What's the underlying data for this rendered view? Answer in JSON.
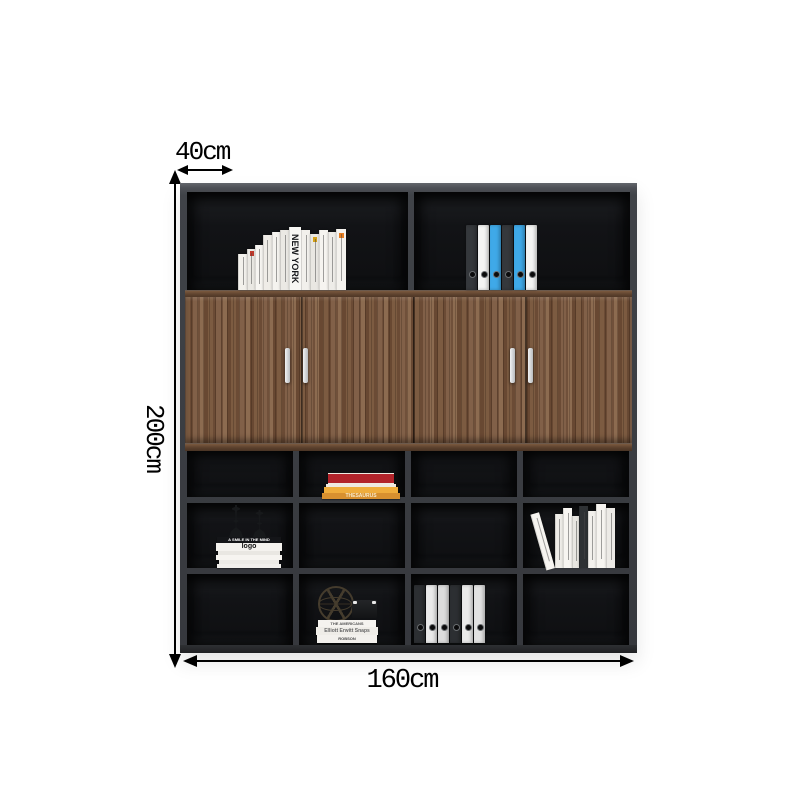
{
  "image": {
    "description": "Walnut and dark-grey office bookcase cabinet shown with measurement arrows",
    "background": "#ffffff"
  },
  "dimensions": {
    "depth": "40cm",
    "height": "200cm",
    "width": "160cm"
  },
  "colors": {
    "line": "#000000",
    "frame": "#3f4247",
    "interior": "#101114",
    "wood": "#7b5a41",
    "wood_trim": "#5e432f",
    "handle": "#e8e9ea",
    "binder_blue": "#3fa9e8"
  },
  "top_shelf": {
    "left_books": [
      {
        "w": 9,
        "h": 36,
        "c": "#f3f1ec"
      },
      {
        "w": 8,
        "h": 41,
        "c": "#eae8e3",
        "mark": "#c0392b"
      },
      {
        "w": 7,
        "h": 45,
        "c": "#f7f5f1"
      },
      {
        "w": 9,
        "h": 55,
        "c": "#efece7"
      },
      {
        "w": 8,
        "h": 58,
        "c": "#f5f3ef"
      },
      {
        "w": 9,
        "h": 60,
        "c": "#ebe9e4"
      },
      {
        "w": 12,
        "h": 63,
        "c": "#f8f7f4",
        "label": "NEW YORK"
      },
      {
        "w": 9,
        "h": 60,
        "c": "#f2f0ec"
      },
      {
        "w": 8,
        "h": 56,
        "c": "#e9e7e2",
        "mark": "#d4a017"
      },
      {
        "w": 9,
        "h": 60,
        "c": "#f6f4f0"
      },
      {
        "w": 8,
        "h": 58,
        "c": "#eeece8"
      },
      {
        "w": 10,
        "h": 61,
        "c": "#f4f2ee",
        "mark": "#e67e22"
      }
    ],
    "right_binders": [
      "#35383c",
      "#f4f4f3",
      "#3fa9e8",
      "#35383c",
      "#3fa9e8",
      "#f4f4f3"
    ]
  },
  "cubbies": {
    "red_stack": [
      {
        "w": 66,
        "h": 9,
        "c": "#b2232a",
        "edge": "#f0ebe2"
      },
      {
        "w": 70,
        "h": 3,
        "c": "#efe9e0"
      },
      {
        "w": 74,
        "h": 6,
        "c": "#f0ad3c"
      },
      {
        "w": 78,
        "h": 6,
        "c": "#d8902f",
        "label": "THESAURUS",
        "lc": "#f7e9c8",
        "fs": 5
      }
    ],
    "candle_stack": [
      {
        "w": 64,
        "h": 6,
        "c": "#141518",
        "label": "A SMILE IN THE MIND",
        "lc": "#ffffff",
        "fs": 4
      },
      {
        "w": 66,
        "h": 8,
        "c": "#f4f2ee",
        "label": "logo",
        "lc": "#111111",
        "fs": 7
      },
      {
        "w": 62,
        "h": 4,
        "c": "#e9e7e2"
      },
      {
        "w": 66,
        "h": 5,
        "c": "#f6f4f0"
      },
      {
        "w": 60,
        "h": 4,
        "c": "#eceae5"
      },
      {
        "w": 64,
        "h": 4,
        "c": "#f1efeb"
      }
    ],
    "leaning_books": [
      {
        "w": 8,
        "h": 58,
        "c": "#f6f4f0",
        "lean": -16
      },
      {
        "w": 7,
        "h": 54,
        "c": "#efede8"
      },
      {
        "w": 8,
        "h": 60,
        "c": "#f7f5f1"
      },
      {
        "w": 6,
        "h": 52,
        "c": "#e8e6e1"
      },
      {
        "w": 8,
        "h": 62,
        "c": "#2e3134"
      },
      {
        "w": 7,
        "h": 57,
        "c": "#f2f0ec"
      },
      {
        "w": 9,
        "h": 64,
        "c": "#f6f4f0"
      },
      {
        "w": 8,
        "h": 60,
        "c": "#eceae6"
      }
    ],
    "decor_stack": [
      {
        "w": 58,
        "h": 7,
        "c": "#f5f3ef",
        "label": "THE AMERICANS",
        "lc": "#555555",
        "fs": 4
      },
      {
        "w": 62,
        "h": 8,
        "c": "#efede8",
        "label": "Elliott Erwitt Snaps",
        "lc": "#666666",
        "fs": 5
      },
      {
        "w": 60,
        "h": 8,
        "c": "#f3f1ed",
        "label": "ROBSON",
        "lc": "#444444",
        "fs": 4
      }
    ],
    "bottom_binders": [
      "#2c2f32",
      "#eaeaea",
      "#dcdcdc",
      "#2c2f32",
      "#eaeaea",
      "#e2e2e2"
    ]
  }
}
